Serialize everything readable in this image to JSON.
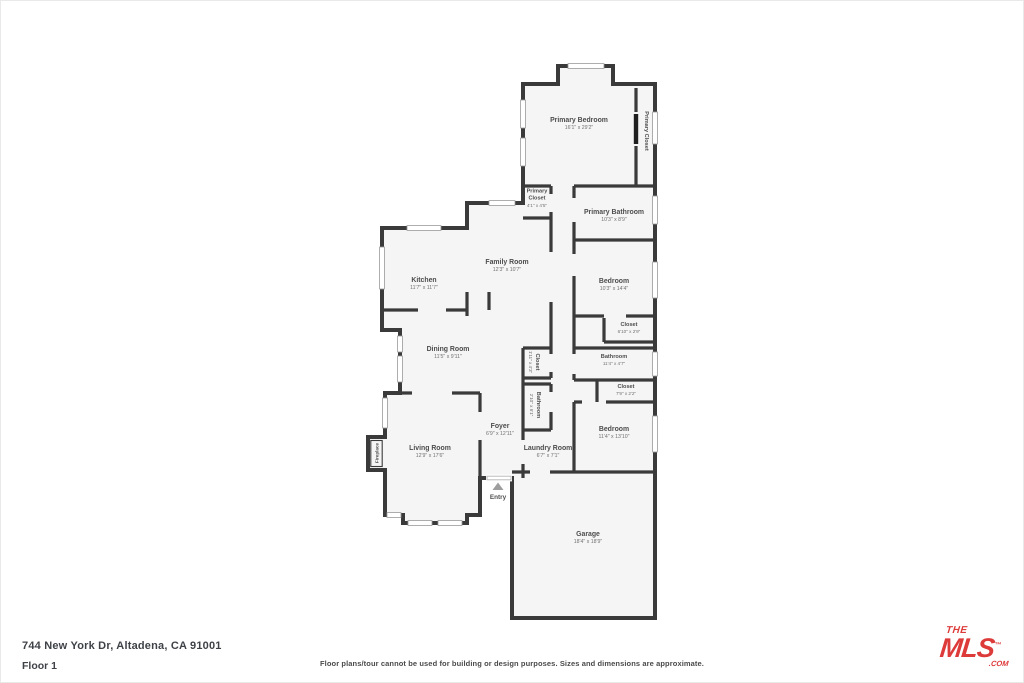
{
  "footer": {
    "address": "744 New York Dr, Altadena, CA 91001",
    "floor_label": "Floor 1",
    "disclaimer": "Floor plans/tour cannot be used for building or design purposes. Sizes and dimensions are approximate.",
    "logo": {
      "the": "THE",
      "mls": "MLS",
      "tm": "™",
      "com": ".COM",
      "color": "#dd3a3a"
    }
  },
  "floorplan": {
    "wall_color": "#3a3a3a",
    "room_fill": "#f5f5f5",
    "label_color": "#4d4d4d",
    "dim_color": "#707070",
    "entry_label": "Entry",
    "fireplace_label": "Fireplace",
    "rooms": [
      {
        "name": "Primary Bedroom",
        "dims": "16'1\" x 29'2\"",
        "x": 579,
        "y": 122,
        "rot": 0
      },
      {
        "name": "Primary Closet",
        "dims": "",
        "x": 645,
        "y": 131,
        "rot": 90,
        "small": true
      },
      {
        "name": "Primary",
        "name2": "Closet",
        "dims": "4'1\" x 4'5\"",
        "x": 537,
        "y": 199,
        "rot": 0,
        "small": true
      },
      {
        "name": "Primary Bathroom",
        "dims": "10'3\" x 8'9\"",
        "x": 614,
        "y": 214,
        "rot": 0
      },
      {
        "name": "Family Room",
        "dims": "12'3\" x 10'7\"",
        "x": 507,
        "y": 264,
        "rot": 0
      },
      {
        "name": "Kitchen",
        "dims": "11'7\" x 11'7\"",
        "x": 424,
        "y": 282,
        "rot": 0
      },
      {
        "name": "Bedroom",
        "dims": "10'3\" x 14'4\"",
        "x": 614,
        "y": 283,
        "rot": 0
      },
      {
        "name": "Closet",
        "dims": "6'10\" x 2'9\"",
        "x": 629,
        "y": 326,
        "rot": 0,
        "small": true
      },
      {
        "name": "Dining Room",
        "dims": "11'5\" x 9'11\"",
        "x": 448,
        "y": 351,
        "rot": 0
      },
      {
        "name": "Closet",
        "dims": "1'11\" x 4'3\"",
        "x": 536,
        "y": 362,
        "rot": 90,
        "small": true
      },
      {
        "name": "Bathroom",
        "dims": "11'4\" x 4'7\"",
        "x": 614,
        "y": 358,
        "rot": 0,
        "small": true
      },
      {
        "name": "Closet",
        "dims": "7'9\" x 2'2\"",
        "x": 626,
        "y": 388,
        "rot": 0,
        "small": true
      },
      {
        "name": "Bathroom",
        "dims": "2'10\" x 6'1\"",
        "x": 537,
        "y": 405,
        "rot": 90,
        "small": true
      },
      {
        "name": "Foyer",
        "dims": "6'9\" x 12'11\"",
        "x": 500,
        "y": 428,
        "rot": 0
      },
      {
        "name": "Bedroom",
        "dims": "11'4\" x 13'10\"",
        "x": 614,
        "y": 431,
        "rot": 0
      },
      {
        "name": "Living Room",
        "dims": "12'9\" x 17'6\"",
        "x": 430,
        "y": 450,
        "rot": 0
      },
      {
        "name": "Laundry Room",
        "dims": "6'7\" x 7'1\"",
        "x": 548,
        "y": 450,
        "rot": 0
      },
      {
        "name": "Garage",
        "dims": "18'4\" x 18'9\"",
        "x": 588,
        "y": 536,
        "rot": 0
      }
    ]
  }
}
